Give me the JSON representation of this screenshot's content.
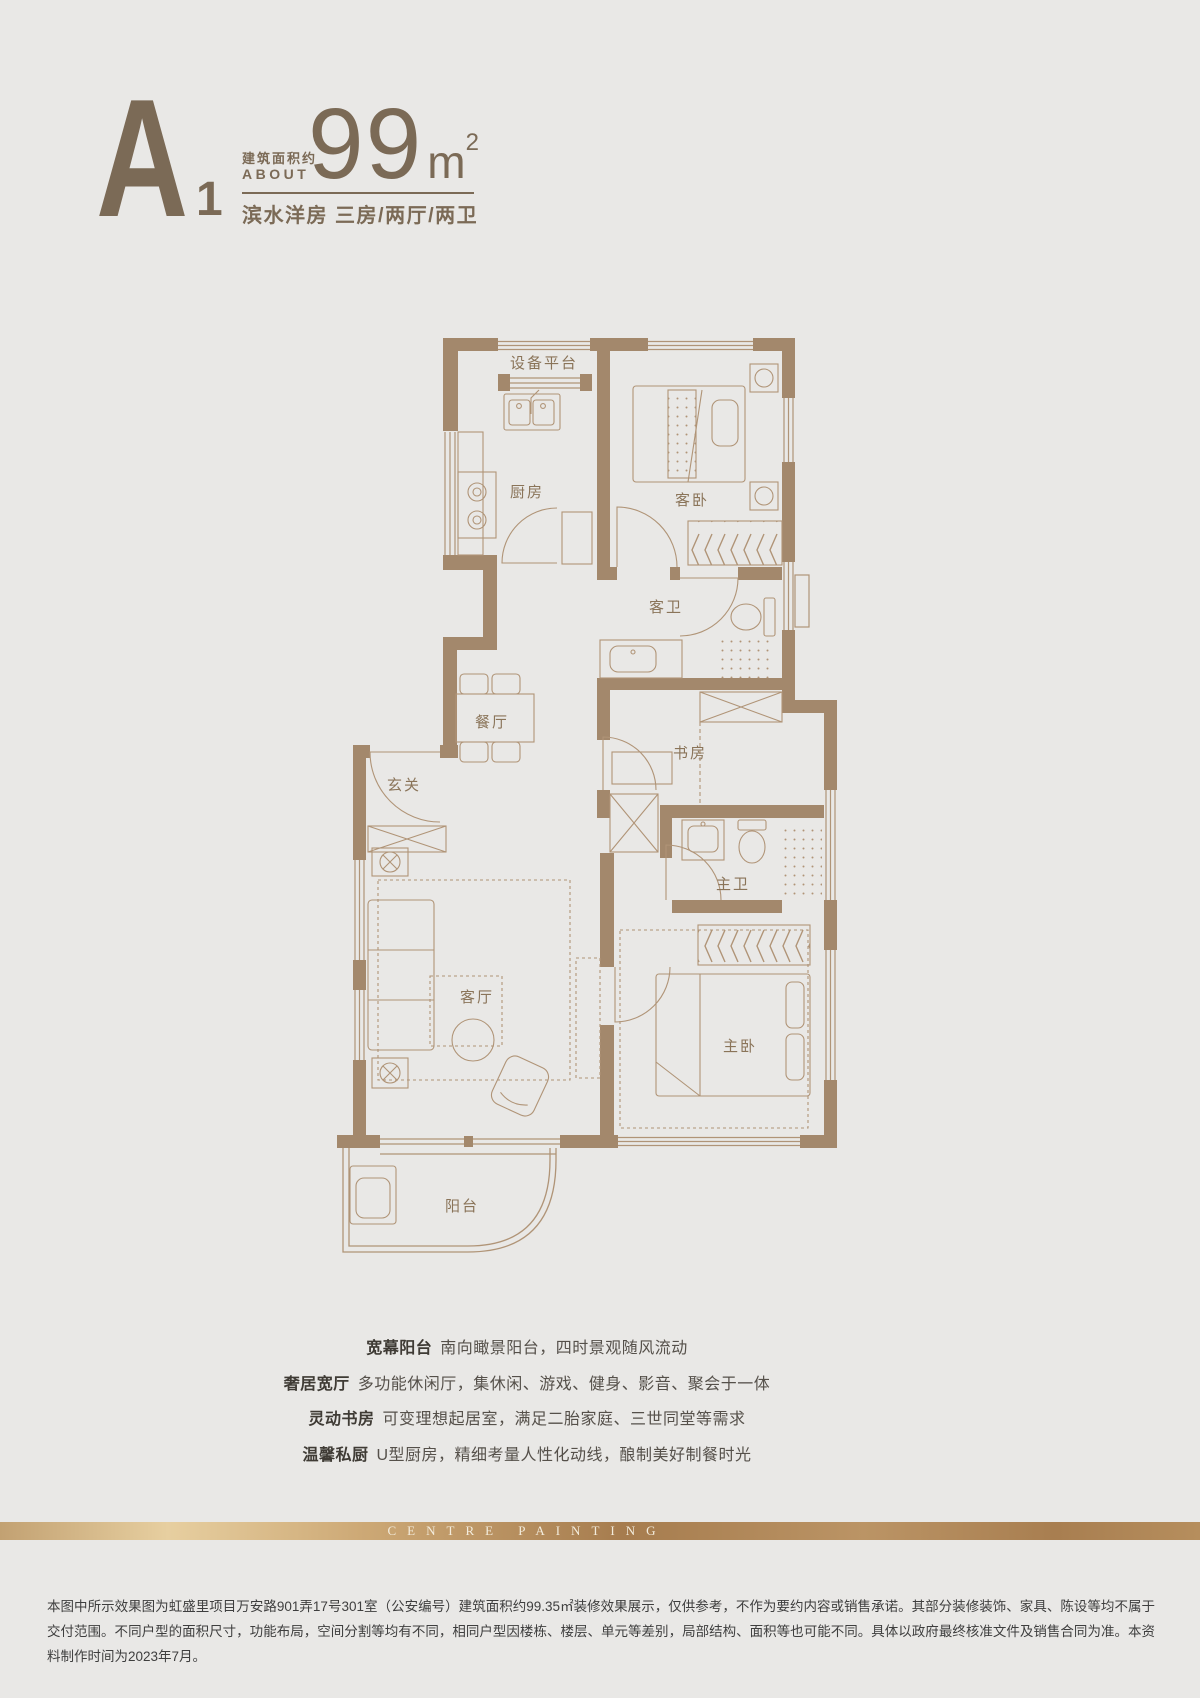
{
  "page": {
    "background": "#e9e8e6"
  },
  "header": {
    "unit_letter": "A",
    "unit_index": "1",
    "area_label_cn": "建筑面积约",
    "area_label_en": "ABOUT",
    "area_value": "99",
    "area_unit_base": "m",
    "area_unit_sup": "2",
    "subtitle": "滨水洋房 三房/两厅/两卫",
    "accent_color": "#7b6a56"
  },
  "floorplan": {
    "wall_color": "#a3886c",
    "line_color": "#b09477",
    "label_color": "#8a7459",
    "rooms": {
      "equipment": "设备平台",
      "kitchen": "厨房",
      "guest_bedroom": "客卧",
      "guest_bath": "客卫",
      "dining": "餐厅",
      "foyer": "玄关",
      "study": "书房",
      "living": "客厅",
      "master_bath": "主卫",
      "master_bedroom": "主卧",
      "balcony": "阳台"
    }
  },
  "features": [
    {
      "title": "宽幕阳台",
      "desc": "南向瞰景阳台，四时景观随风流动"
    },
    {
      "title": "奢居宽厅",
      "desc": "多功能休闲厅，集休闲、游戏、健身、影音、聚会于一体"
    },
    {
      "title": "灵动书房",
      "desc": "可变理想起居室，满足二胎家庭、三世同堂等需求"
    },
    {
      "title": "温馨私厨",
      "desc": "U型厨房，精细考量人性化动线，酿制美好制餐时光"
    }
  ],
  "band": {
    "text": "CENTRE PAINTING"
  },
  "disclaimer": "本图中所示效果图为虹盛里项目万安路901弄17号301室（公安编号）建筑面积约99.35㎡装修效果展示，仅供参考，不作为要约内容或销售承诺。其部分装修装饰、家具、陈设等均不属于交付范围。不同户型的面积尺寸，功能布局，空间分割等均有不同，相同户型因楼栋、楼层、单元等差别，局部结构、面积等也可能不同。具体以政府最终核准文件及销售合同为准。本资料制作时间为2023年7月。"
}
